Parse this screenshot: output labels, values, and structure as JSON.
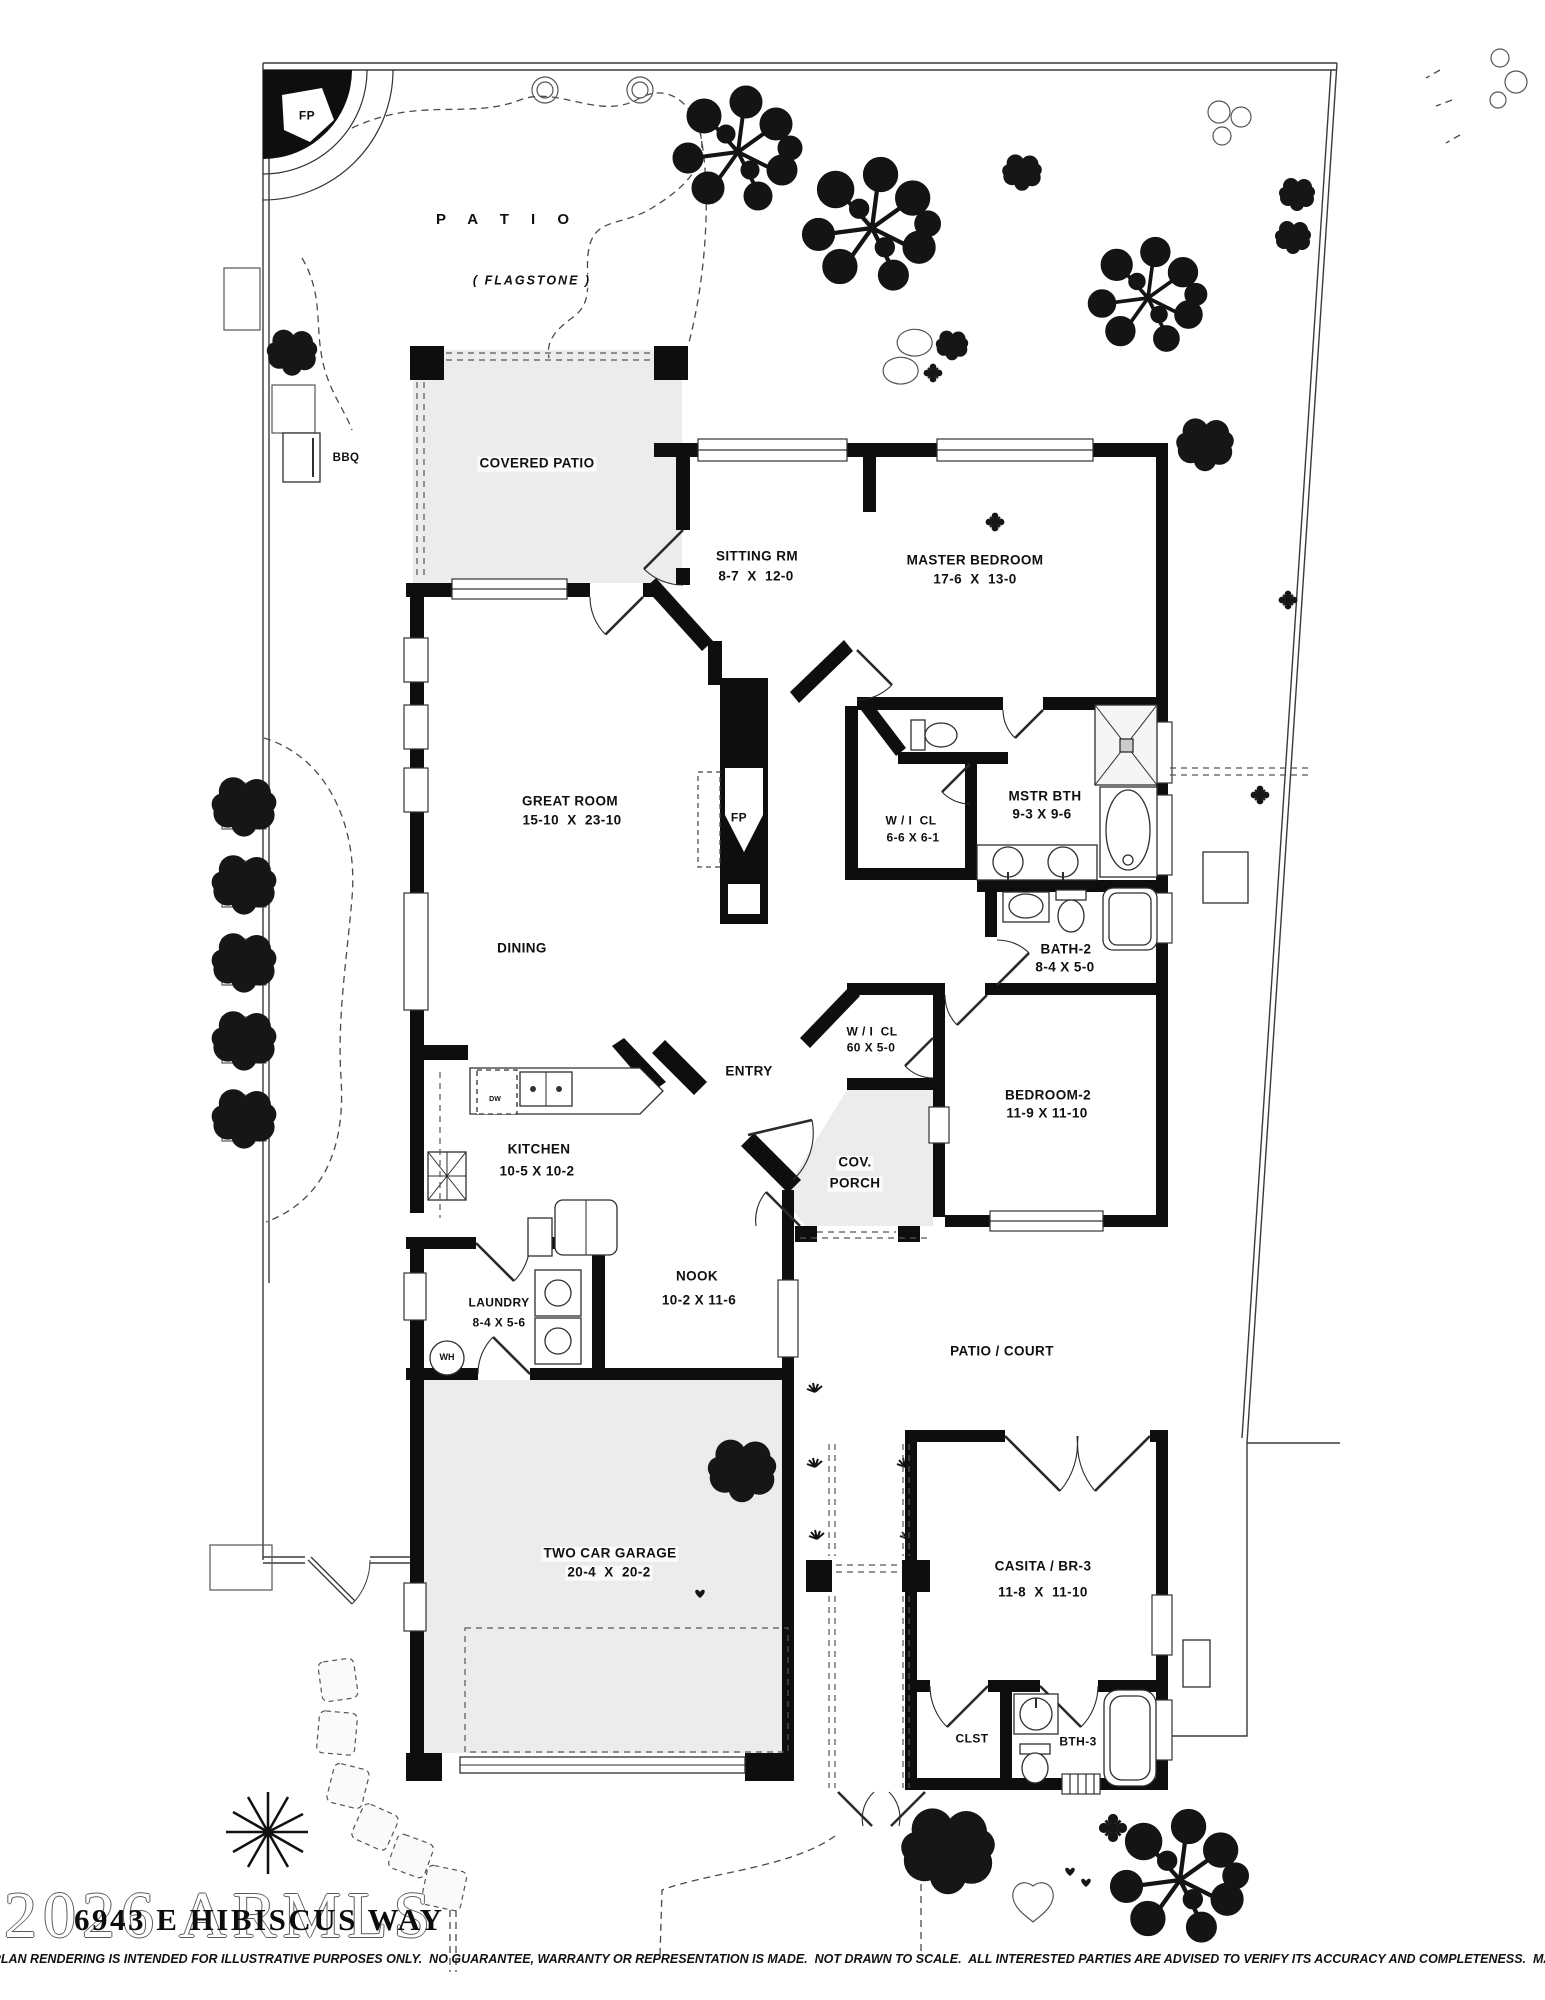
{
  "rooms": {
    "patio": {
      "name": "P A T I O",
      "sub": "( FLAGSTONE )"
    },
    "covered_patio": {
      "name": "COVERED PATIO"
    },
    "sitting": {
      "name": "SITTING RM",
      "dims": "8-7  X  12-0"
    },
    "master": {
      "name": "MASTER BEDROOM",
      "dims": "17-6  X  13-0"
    },
    "great": {
      "name": "GREAT ROOM",
      "dims": "15-10  X  23-10"
    },
    "master_closet": {
      "name": "W / I  CL",
      "dims": "6-6 X 6-1"
    },
    "master_bath": {
      "name": "MSTR BTH",
      "dims": "9-3 X 9-6"
    },
    "bath2": {
      "name": "BATH-2",
      "dims": "8-4 X 5-0"
    },
    "dining": {
      "name": "DINING"
    },
    "closet2": {
      "name": "W / I  CL",
      "dims": "60 X 5-0"
    },
    "entry": {
      "name": "ENTRY"
    },
    "bedroom2": {
      "name": "BEDROOM-2",
      "dims": "11-9 X 11-10"
    },
    "kitchen": {
      "name": "KITCHEN",
      "dims": "10-5 X 10-2"
    },
    "cov_porch": {
      "line1": "COV.",
      "line2": "PORCH"
    },
    "nook": {
      "name": "NOOK",
      "dims": "10-2 X 11-6"
    },
    "laundry": {
      "name": "LAUNDRY",
      "dims": "8-4 X 5-6"
    },
    "patio_court": {
      "name": "PATIO / COURT"
    },
    "garage": {
      "name": "TWO CAR GARAGE",
      "dims": "20-4  X  20-2"
    },
    "casita": {
      "name": "CASITA / BR-3",
      "dims": "11-8  X  11-10"
    },
    "clst": {
      "name": "CLST"
    },
    "bth3": {
      "name": "BTH-3"
    }
  },
  "markers": {
    "fp": "FP",
    "bbq": "BBQ",
    "wh": "WH",
    "dw": "DW"
  },
  "footer": {
    "watermark": "2026 ARMLS",
    "address": "6943 E HIBISCUS WAY",
    "disclaimer": "FLOORPLAN RENDERING IS INTENDED FOR ILLUSTRATIVE PURPOSES ONLY.  NO GUARANTEE, WARRANTY OR REPRESENTATION IS MADE.  NOT DRAWN TO SCALE.  ALL INTERESTED PARTIES ARE ADVISED TO VERIFY ITS ACCURACY AND COMPLETENESS.  MAR. 2026"
  },
  "colors": {
    "wall": "#0e0e0e",
    "shaded_fill": "#ececec",
    "line": "#2e2e2e"
  }
}
